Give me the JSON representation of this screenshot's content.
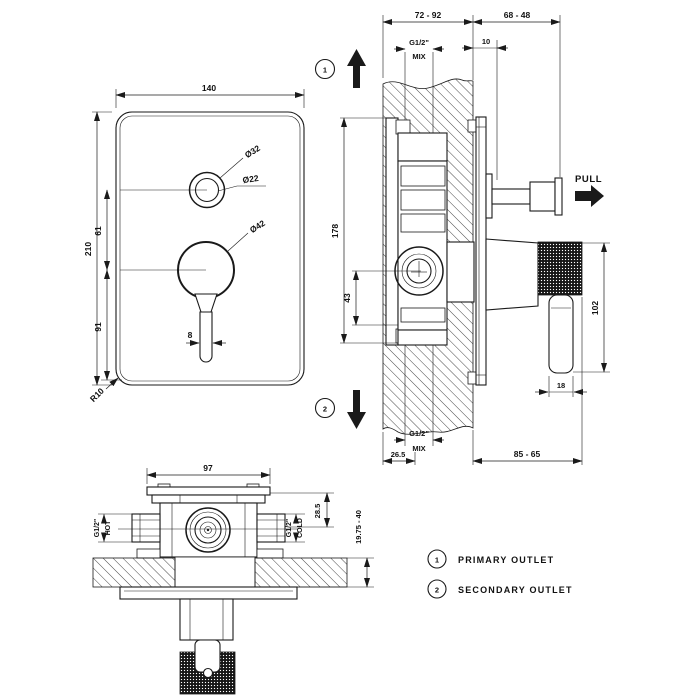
{
  "title": "Concealed shower mixer installation drawing",
  "colors": {
    "line": "#1a1a1a",
    "background": "#ffffff"
  },
  "front_view": {
    "width": "140",
    "height": "210",
    "spacing_top": "61",
    "spacing_bottom": "91",
    "dia_outer": "Ø32",
    "dia_inner": "Ø22",
    "dia_knob": "Ø42",
    "lever_width": "8",
    "corner_radius": "R10"
  },
  "section_view": {
    "recess_depth_range": "72 - 92",
    "knob_projection_range": "68 - 48",
    "plate_offset": "10",
    "mix_top": {
      "thread": "G1/2\"",
      "label": "MIX"
    },
    "mix_bottom": {
      "thread": "G1/2\"",
      "label": "MIX"
    },
    "pull_label": "PULL",
    "body_height": "178",
    "cartridge_offset": "43",
    "handle_length": "102",
    "handle_width": "18",
    "mix_offset": "26.5",
    "handle_projection_range": "85 - 65",
    "callout_primary": "1",
    "callout_secondary": "2"
  },
  "bottom_view": {
    "body_width": "97",
    "inlet_offset": "28.5",
    "wall_thickness_range": "19.75 - 40",
    "hot": {
      "thread": "G1/2\"",
      "label": "HOT"
    },
    "cold": {
      "thread": "G1/2\"",
      "label": "COLD"
    }
  },
  "legend": {
    "items": [
      {
        "num": "1",
        "label": "PRIMARY OUTLET"
      },
      {
        "num": "2",
        "label": "SECONDARY OUTLET"
      }
    ]
  }
}
